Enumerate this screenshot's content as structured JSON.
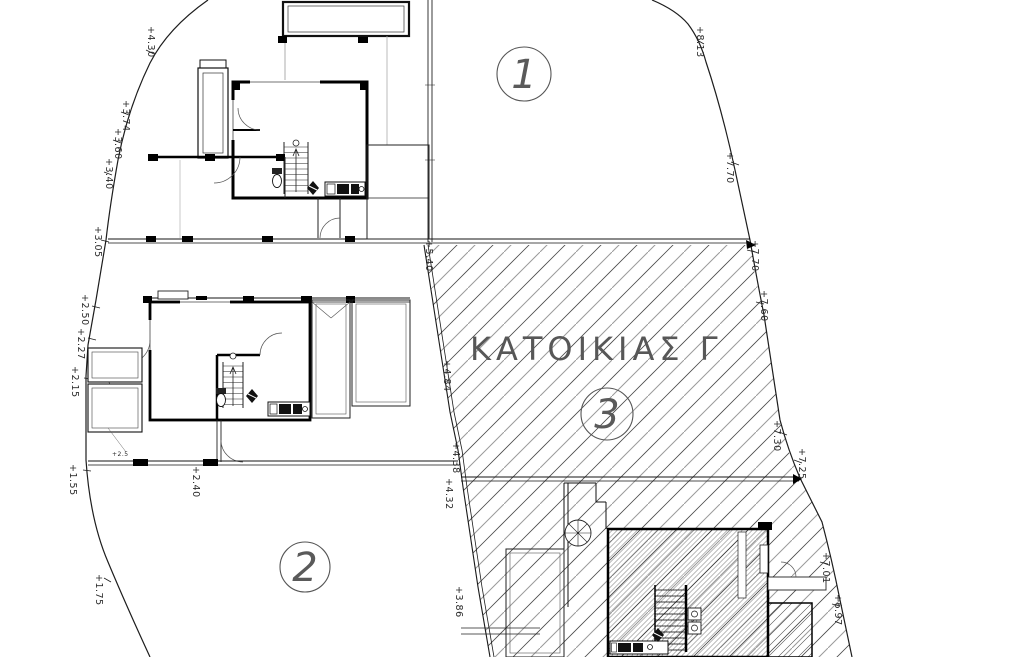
{
  "drawing": {
    "area_label": "ΚΑΤΟΙΚΙΑΣ  Γ",
    "zones": [
      {
        "number": "1"
      },
      {
        "number": "2"
      },
      {
        "number": "3"
      }
    ],
    "elevation_markers": [
      {
        "label": "+4.30",
        "x": 148,
        "y": 26,
        "rotate": 90,
        "size": 9.5
      },
      {
        "label": "+3.74",
        "x": 123,
        "y": 100,
        "rotate": 90,
        "size": 9.5
      },
      {
        "label": "+3.60",
        "x": 115,
        "y": 128,
        "rotate": 90,
        "size": 9.5
      },
      {
        "label": "+3.40",
        "x": 106,
        "y": 158,
        "rotate": 90,
        "size": 9.5
      },
      {
        "label": "+3.05",
        "x": 95,
        "y": 226,
        "rotate": 90,
        "size": 9.5
      },
      {
        "label": "+2.50",
        "x": 82,
        "y": 294,
        "rotate": 90,
        "size": 9.5
      },
      {
        "label": "+2.27",
        "x": 78,
        "y": 328,
        "rotate": 90,
        "size": 9.5
      },
      {
        "label": "+2.15",
        "x": 72,
        "y": 366,
        "rotate": 90,
        "size": 9.5
      },
      {
        "label": "+1.55",
        "x": 70,
        "y": 464,
        "rotate": 90,
        "size": 9.5
      },
      {
        "label": "+1.75",
        "x": 96,
        "y": 574,
        "rotate": 90,
        "size": 9.5
      },
      {
        "label": "+5.40",
        "x": 426,
        "y": 240,
        "rotate": 90,
        "size": 9.5
      },
      {
        "label": "+4.84",
        "x": 444,
        "y": 360,
        "rotate": 90,
        "size": 9.5
      },
      {
        "label": "+4.38",
        "x": 453,
        "y": 442,
        "rotate": 90,
        "size": 9.5
      },
      {
        "label": "+4.32",
        "x": 446,
        "y": 478,
        "rotate": 90,
        "size": 9.5
      },
      {
        "label": "+3.86",
        "x": 456,
        "y": 586,
        "rotate": 90,
        "size": 9.5
      },
      {
        "label": "+2.40",
        "x": 193,
        "y": 466,
        "rotate": 90,
        "size": 9.5
      },
      {
        "label": "+2.5",
        "x": 112,
        "y": 456,
        "rotate": 0,
        "size": 6
      },
      {
        "label": "+8.13",
        "x": 697,
        "y": 26,
        "rotate": 90,
        "size": 9.5
      },
      {
        "label": "+7.70",
        "x": 727,
        "y": 152,
        "rotate": 90,
        "size": 9.5
      },
      {
        "label": "+7.70",
        "x": 752,
        "y": 240,
        "rotate": 90,
        "size": 9.5
      },
      {
        "label": "+7.60",
        "x": 761,
        "y": 290,
        "rotate": 90,
        "size": 9.5
      },
      {
        "label": "+7.30",
        "x": 774,
        "y": 420,
        "rotate": 90,
        "size": 9.5
      },
      {
        "label": "+7.25",
        "x": 799,
        "y": 448,
        "rotate": 90,
        "size": 9.5
      },
      {
        "label": "+7.01",
        "x": 823,
        "y": 552,
        "rotate": 90,
        "size": 9.5
      },
      {
        "label": "+6.97",
        "x": 835,
        "y": 594,
        "rotate": 90,
        "size": 9.5
      }
    ]
  }
}
